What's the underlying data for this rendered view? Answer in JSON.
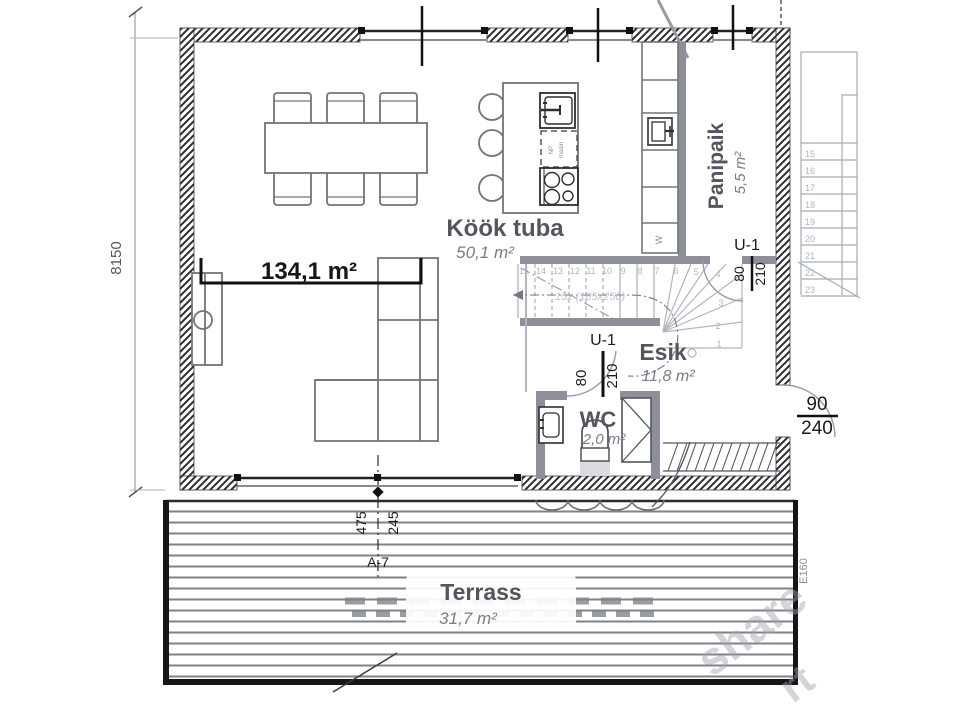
{
  "plan": {
    "total_area": "134,1 m²",
    "rooms": {
      "kook": {
        "name": "Köök tuba",
        "area": "50,1 m²"
      },
      "panipaik": {
        "name": "Panipaik",
        "area": "5,5 m²"
      },
      "esik": {
        "name": "Esik",
        "area": "11,8 m²"
      },
      "wc": {
        "name": "WC",
        "area": "2,0 m²"
      },
      "terrass": {
        "name": "Terrass",
        "area": "31,7 m²"
      }
    },
    "doors": {
      "u1_panipaik": {
        "code": "U-1",
        "w": "80",
        "h": "210"
      },
      "u1_wc": {
        "code": "U-1",
        "w": "80",
        "h": "210"
      },
      "front": {
        "w": "90",
        "h": "240"
      }
    },
    "dims": {
      "left_height": "8150",
      "section": "A-7",
      "sec_left": "475",
      "sec_right": "245",
      "terrace_edge": "E160"
    },
    "stairs": {
      "note": "15x (185x250)",
      "main": [
        "15",
        "14",
        "13",
        "12",
        "11",
        "10",
        "9",
        "8",
        "7",
        "6",
        "5",
        "4"
      ],
      "winder": [
        "3",
        "2",
        "1"
      ],
      "upper": [
        "15",
        "16",
        "17",
        "18",
        "19",
        "20",
        "21",
        "22",
        "23"
      ]
    },
    "appliances": {
      "washer": "W",
      "dw1": "NP",
      "dw2": "masin"
    },
    "watermark": {
      "a": "share",
      "b": "rt"
    }
  },
  "colors": {
    "wall_hatch": "#2c2c32",
    "interior_wall": "#8f8f99",
    "furniture_line": "#73737b",
    "room_label": "#55555f",
    "area_label": "#7b7b84",
    "stair_light": "#b4b4bf",
    "dimension_black": "#1b1b1f",
    "deck_line": "#81818a",
    "watermark": "#a3a3ac"
  }
}
